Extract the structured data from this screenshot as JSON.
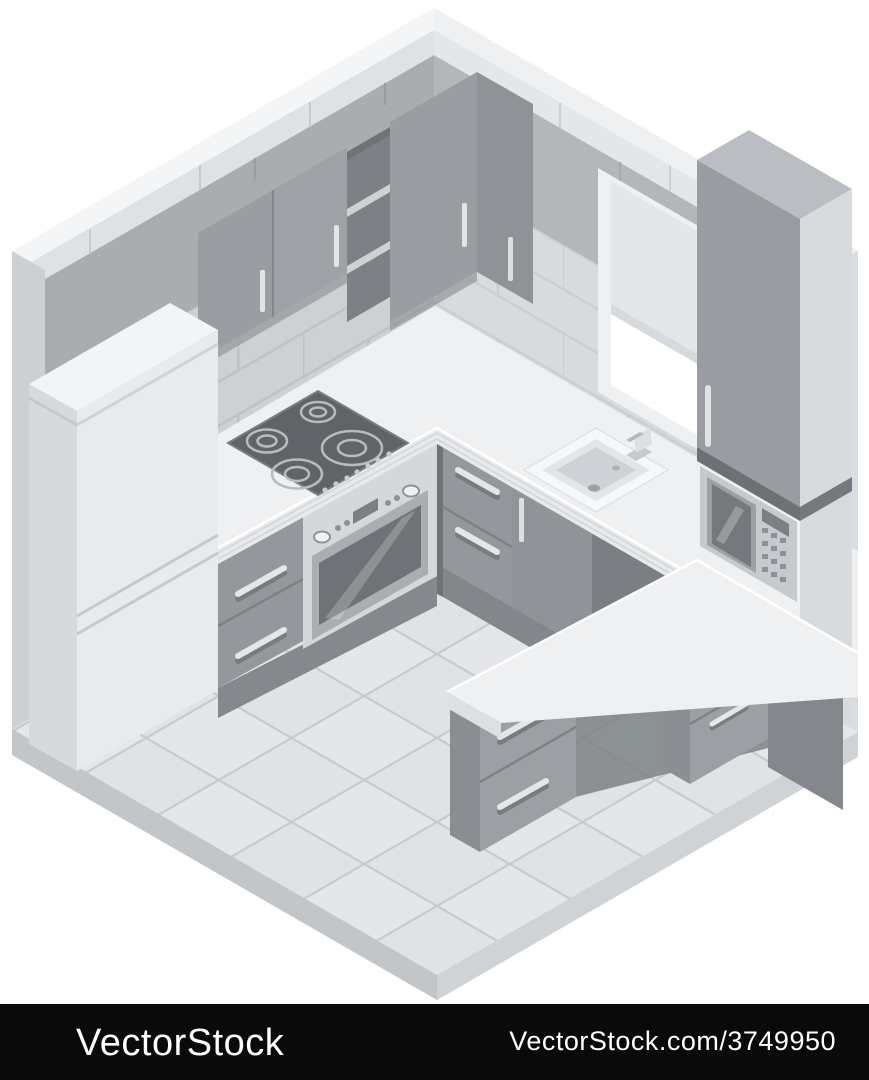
{
  "watermark_bar": {
    "left_text": "VectorStock",
    "right_text": "VectorStock.com/3749950",
    "background": "#0a0a0a",
    "text_color": "#ffffff"
  },
  "scene": {
    "description": "Isometric kitchen interior illustration in gray tones",
    "style": "flat isometric vector",
    "palette": {
      "background": "#ffffff",
      "shell": "#e9ebec",
      "outer_band_left": "#f4f5f7",
      "outer_band_right": "#eef0f2",
      "wall_cap": "#dfe2e5",
      "wall_left": "#a9adb0",
      "wall_right": "#b3b7ba",
      "tiles_left": "#cdd1d4",
      "tiles_right": "#d8dbde",
      "grout": "#bec2c5",
      "floor": "#e4e6e9",
      "floor_grid": "#c7cacd",
      "counter": "#eef0f2",
      "cabinet_front": "#94989c",
      "cabinet_side": "#84888c",
      "appliance_dark": "#606468",
      "white_goods": "#e8eaed",
      "handle": "#e2e4e7"
    },
    "objects": [
      "refrigerator",
      "wall-cabinet-doors",
      "open-shelves",
      "corner-wall-cabinet",
      "induction-hob",
      "built-in-oven",
      "base-drawer-units",
      "base-door-cabinet",
      "kitchen-sink",
      "faucet",
      "window-with-roller-blind",
      "window-sill",
      "tall-cabinet",
      "built-in-microwave",
      "bar-counter",
      "bar-pedestal-drawers",
      "under-bar-drawer-unit",
      "end-panel",
      "tiled-floor",
      "subway-tile-walls"
    ]
  }
}
